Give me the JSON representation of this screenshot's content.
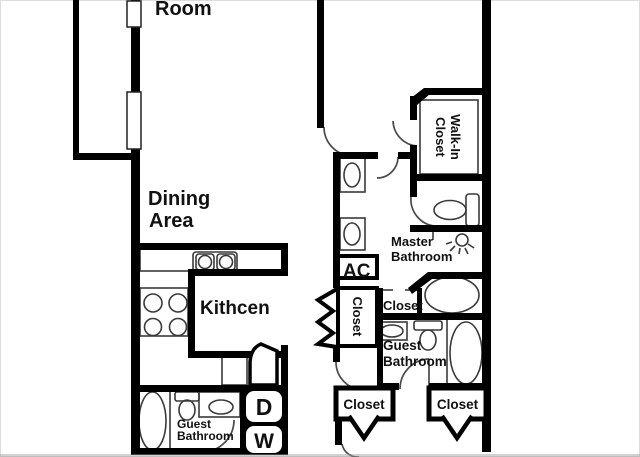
{
  "plan": {
    "title": "apartment floor plan",
    "labels": {
      "living_room": "Room",
      "dining_line1": "Dining",
      "dining_line2": "Area",
      "kitchen": "Kithcen",
      "guest_bath_left_line1": "Guest",
      "guest_bath_left_line2": "Bathroom",
      "master_bath_line1": "Master",
      "master_bath_line2": "Bathroom",
      "guest_bath_right_line1": "Guest",
      "guest_bath_right_line2": "Bathroom",
      "walkin_closet_line1": "Walk-In",
      "walkin_closet_line2": "Closet",
      "ac_unit": "AC",
      "hall_closet": "Closet",
      "master_closet": "Closet",
      "bedroom_closet_left": "Closet",
      "bedroom_closet_right": "Closet",
      "dryer": "D",
      "washer": "W"
    },
    "colors": {
      "wall": "#000000",
      "fixture_line": "#3a3a3a",
      "text": "#111111",
      "background": "#ffffff",
      "page_border": "#dcdcdc"
    }
  }
}
